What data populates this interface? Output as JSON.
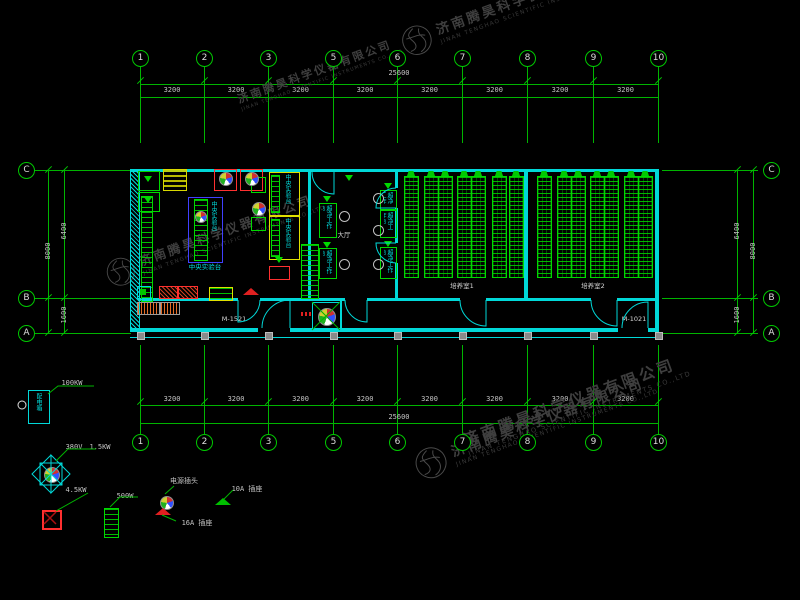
{
  "watermark": {
    "cn": "济南腾昊科学仪器有限公司",
    "en": "JINAN TENGHAO SCIENTIFIC INSTRUMENTS CO.,LTD"
  },
  "grid": {
    "top_bubbles": [
      "1",
      "2",
      "3",
      "5",
      "6",
      "7",
      "8",
      "9",
      "10"
    ],
    "bottom_bubbles": [
      "1",
      "2",
      "3",
      "5",
      "6",
      "7",
      "8",
      "9",
      "10"
    ],
    "left_rows": [
      "C",
      "B",
      "A"
    ],
    "right_rows": [
      "C",
      "B",
      "A"
    ],
    "top_spans": [
      "3200",
      "3200",
      "3200",
      "3200",
      "3200",
      "3200",
      "3200",
      "3200"
    ],
    "bottom_spans": [
      "3200",
      "3200",
      "3200",
      "3200",
      "3200",
      "3200",
      "3200",
      "3200"
    ],
    "top_total": "25600",
    "bottom_total": "25600",
    "left_dims": {
      "upper": "6400",
      "total": "8000",
      "lower": "1600"
    },
    "right_dims": {
      "upper": "6400",
      "total": "8000",
      "lower": "1600"
    }
  },
  "plan": {
    "doors": {
      "main_left": "M-1521",
      "main_right": "M-1021"
    },
    "rooms": {
      "hall_label": "大厅",
      "culture1_label": "培养室1",
      "culture2_label": "培养室2",
      "bench_label": "中央实验台",
      "bench_caption": "中央实验台",
      "clean_bench_label": "超净工作台"
    }
  },
  "legend": {
    "distribution_box": {
      "label": "配电箱",
      "power": "100KW"
    },
    "fan": {
      "voltage": "380V",
      "power": "1.5KW",
      "power2": "4.5KW"
    },
    "rack_power": "500W",
    "plug_label": "电源插头",
    "socket_16a": "16A 插座",
    "socket_10a": "10A 插座"
  }
}
